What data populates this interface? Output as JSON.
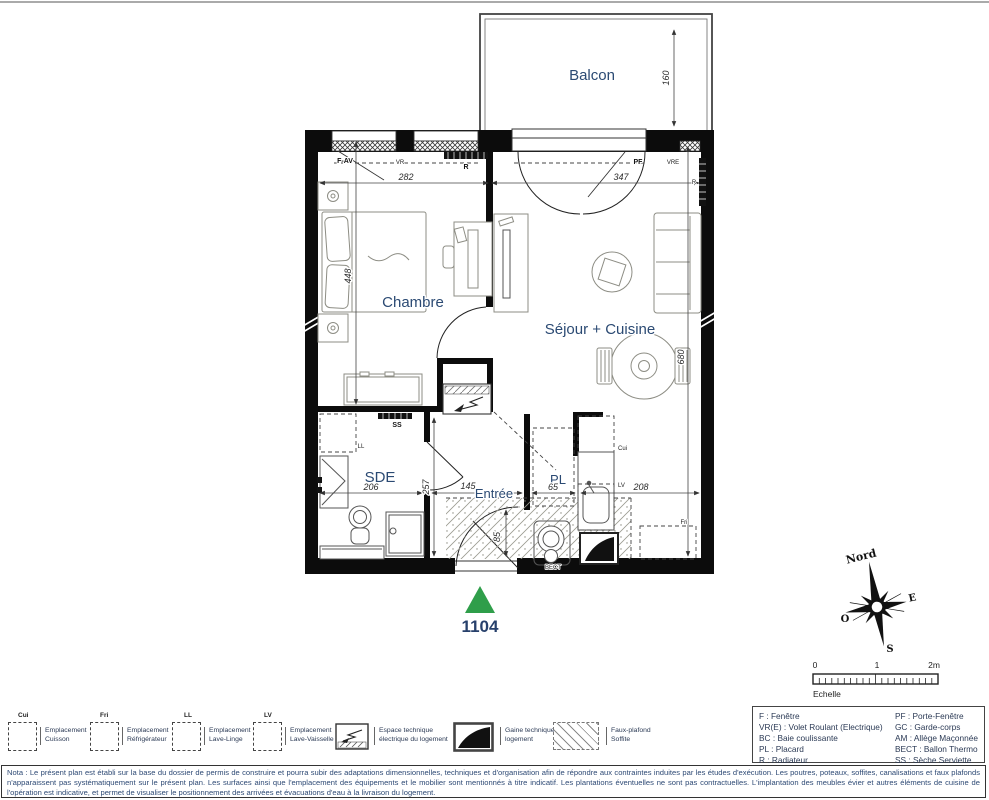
{
  "plan": {
    "unit_number": "1104",
    "rooms": {
      "balcon": "Balcon",
      "chambre": "Chambre",
      "sejour_cuisine": "Séjour + Cuisine",
      "sde": "SDE",
      "entree": "Entrée",
      "placard": "PL"
    },
    "dimensions_cm": {
      "balcon_depth": "160",
      "chambre_width": "282",
      "sejour_width": "347",
      "chambre_length": "448",
      "sejour_length": "680",
      "sde_width": "206",
      "sde_length": "257",
      "entree_width": "145",
      "placard_width": "65",
      "cuisine_width": "208",
      "entree_door": "85"
    },
    "annotations": {
      "f_av": "F-AV",
      "vr": "VR",
      "r_top": "R",
      "pf": "PF",
      "vre": "VRE",
      "r_right": "R",
      "ss": "SS",
      "ll": "LL",
      "cui": "Cui",
      "lv": "LV",
      "fri": "Fri",
      "bect": "BECT"
    }
  },
  "compass": {
    "north": "Nord",
    "east": "E",
    "south": "S",
    "west": "O"
  },
  "scale_bar": {
    "tick_0": "0",
    "tick_1": "1",
    "tick_2": "2m",
    "label": "Echelle"
  },
  "legend": {
    "emplacements": [
      {
        "tag": "Cui",
        "label": "Emplacement\nCuisson"
      },
      {
        "tag": "Fri",
        "label": "Emplacement\nRéfrigérateur"
      },
      {
        "tag": "LL",
        "label": "Emplacement\nLave-Linge"
      },
      {
        "tag": "LV",
        "label": "Emplacement\nLave-Vaisselle"
      }
    ],
    "espace_technique_label": "Espace technique\nélectrique du logement",
    "gaine_label": "Gaine technique\nlogement",
    "faux_plafond_label": "Faux-plafond\nSoffite"
  },
  "abbreviations": {
    "left": [
      "F : Fenêtre",
      "VR(E) : Volet Roulant (Electrique)",
      "BC : Baie coulissante",
      "PL : Placard",
      "R : Radiateur"
    ],
    "right": [
      "PF : Porte-Fenêtre",
      "GC : Garde-corps",
      "AM : Allège Maçonnée",
      "BECT : Ballon Thermo",
      "SS : Sèche Serviette"
    ]
  },
  "nota": "Nota : Le présent plan est établi sur la base du dossier de permis de construire et pourra subir des adaptations dimensionnelles, techniques et d'organisation afin de répondre aux contraintes induites par les études d'exécution. Les poutres, poteaux, soffites, canalisations et faux plafonds n'apparaissent pas systématiquement sur le présent plan. Les surfaces ainsi que l'emplacement des équipements et le mobilier sont mentionnés à titre indicatif. Les plantations éventuelles ne sont pas contractuelles. L'implantation des meubles évier et autres éléments de cuisine de l'opération est indicative, et permet de visualiser le positionnement des arrivées et évacuations d'eau à la livraison du logement.",
  "colors": {
    "entrance_marker_green": "#2f9e4a",
    "label_navy": "#2b4a73",
    "wall_black": "#0c0c0c",
    "furniture_gray": "#8d8d84"
  }
}
